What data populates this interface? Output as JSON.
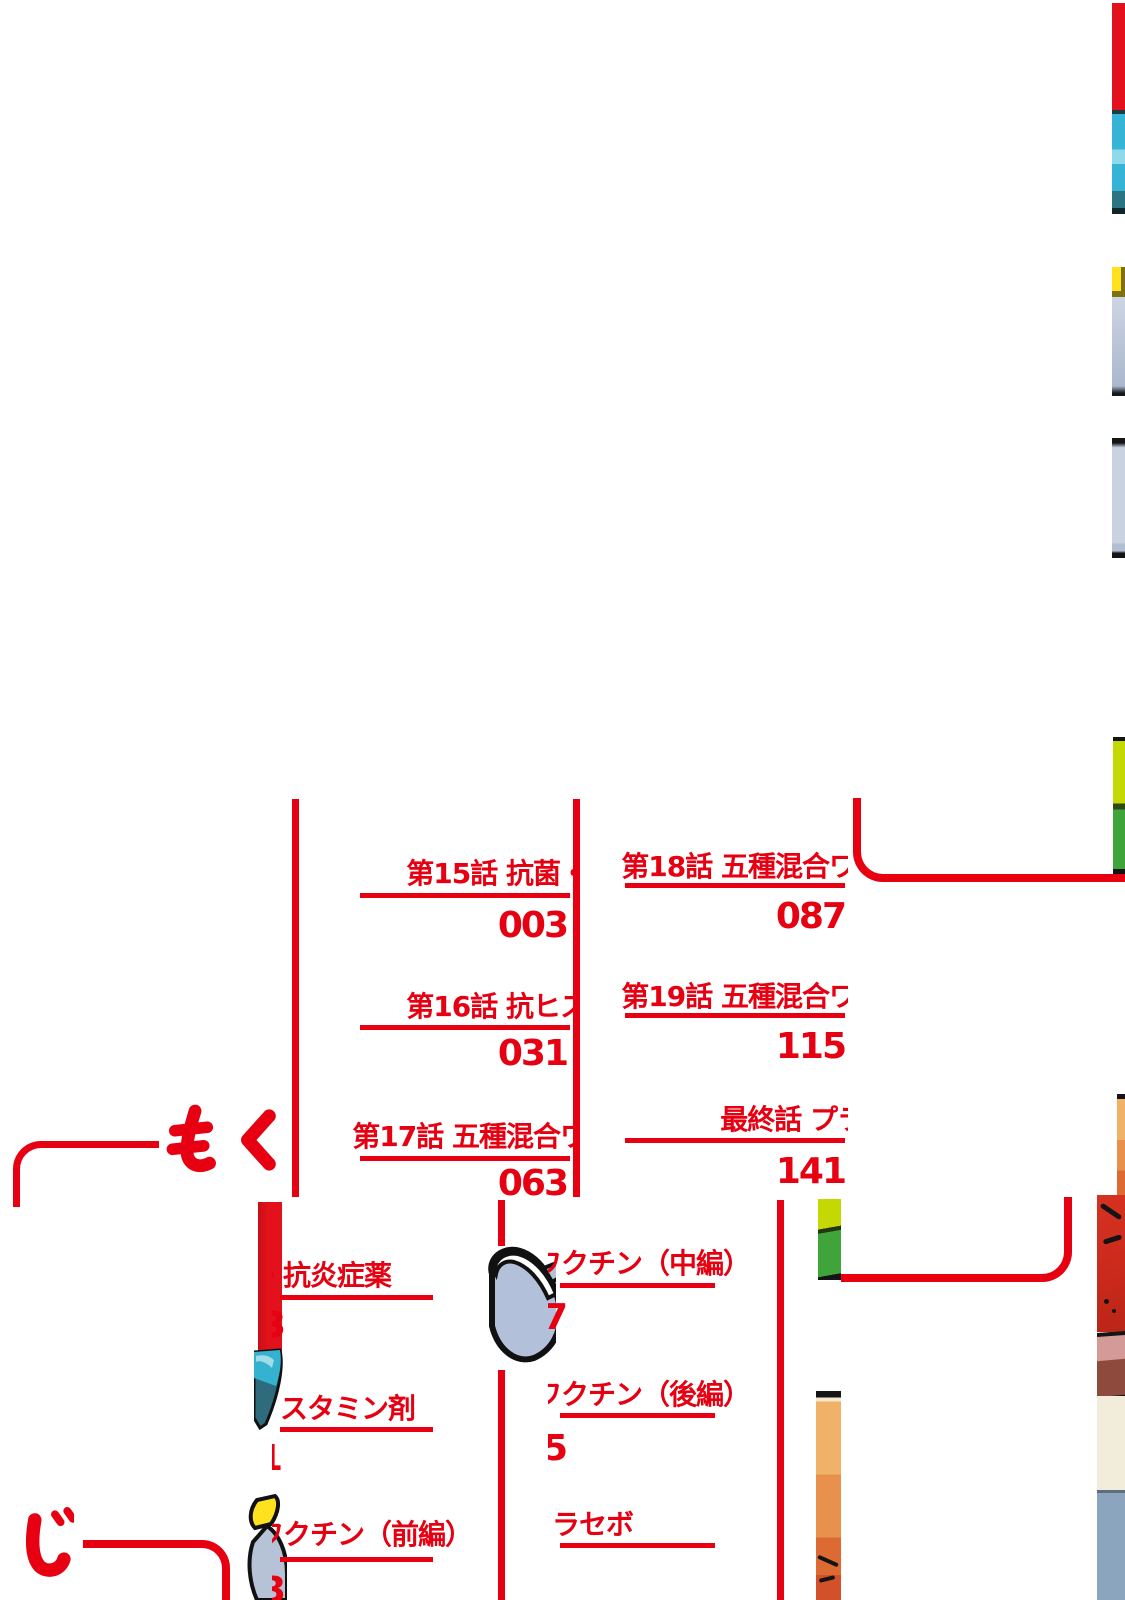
{
  "colors": {
    "accent_red": "#e60012",
    "art_red": "#e3111b",
    "cyan": "#35b4d6",
    "teal": "#2b7484",
    "yellow": "#ffe11e",
    "blue_gray": "#b6c2d6",
    "lime": "#c4d903",
    "green": "#3fa43a",
    "orange": "#eda55e",
    "jacket_red": "#cb2a1b",
    "jacket_pink": "#d49a97",
    "jacket_maroon": "#8d4a3d",
    "jacket_cream": "#f2ecdb",
    "jacket_slate": "#8ca5bf"
  },
  "heading": {
    "mo": "も",
    "ku": "く",
    "ji": "じ",
    "label": "もくじ"
  },
  "toc_top": {
    "left_column": [
      {
        "title": "第15話 抗菌・",
        "page": "003"
      },
      {
        "title": "第16話 抗ヒス",
        "page": "031"
      },
      {
        "title": "第17話 五種混合ワ",
        "page": "063"
      }
    ],
    "right_column": [
      {
        "title": "第18話 五種混合ワ",
        "page": "087"
      },
      {
        "title": "第19話 五種混合ワ",
        "page": "115"
      },
      {
        "title": "最終話 プラ",
        "page": "141"
      }
    ]
  },
  "toc_bottom": {
    "col1": [
      {
        "title": "・抗炎症薬",
        "page_fragment": "3"
      },
      {
        "title": "スタミン剤",
        "page_fragment": "1"
      },
      {
        "title": "ワクチン（前編）",
        "page_fragment": "3"
      }
    ],
    "col2": [
      {
        "title": "ワクチン（中編）",
        "page_fragment": "7"
      },
      {
        "title": "ワクチン（後編）",
        "page_fragment": "5"
      },
      {
        "title": "ラセボ",
        "page_fragment": ""
      }
    ]
  }
}
